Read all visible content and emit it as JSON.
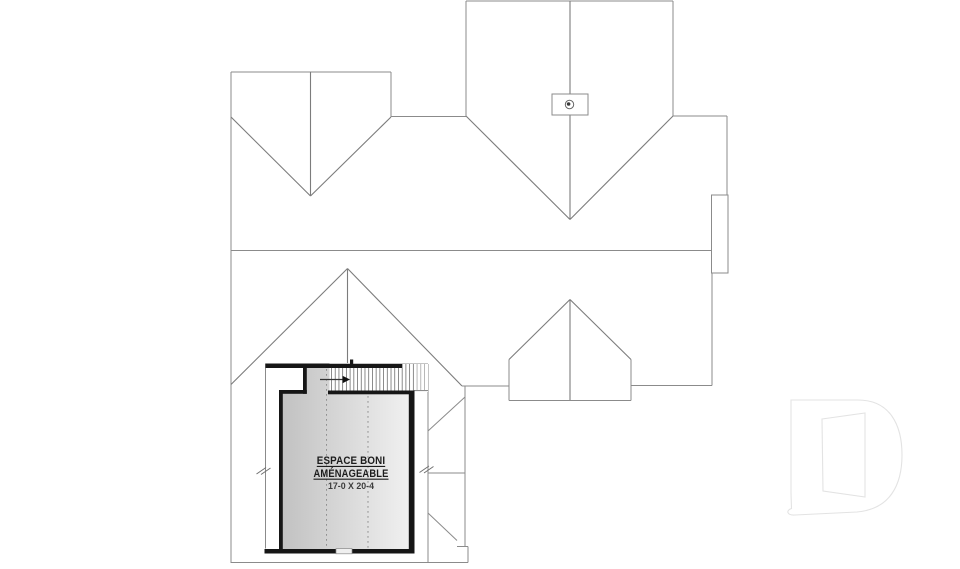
{
  "plan": {
    "type": "roof-and-bonus-space-plan",
    "bonus_room": {
      "label_line1": "ESPACE BONI",
      "label_line2": "AMÉNAGEABLE",
      "dimensions": "17-0 X 20-4"
    }
  },
  "watermark": {
    "letter": "D"
  },
  "colors": {
    "background": "#ffffff",
    "roof_line": "#8b8b8b",
    "wall": "#161616",
    "room_fill_dark": "#c2c2c2",
    "room_fill_light": "#f4f4f4",
    "logo": "#e3e3e3",
    "text": "#1c1c1c"
  }
}
